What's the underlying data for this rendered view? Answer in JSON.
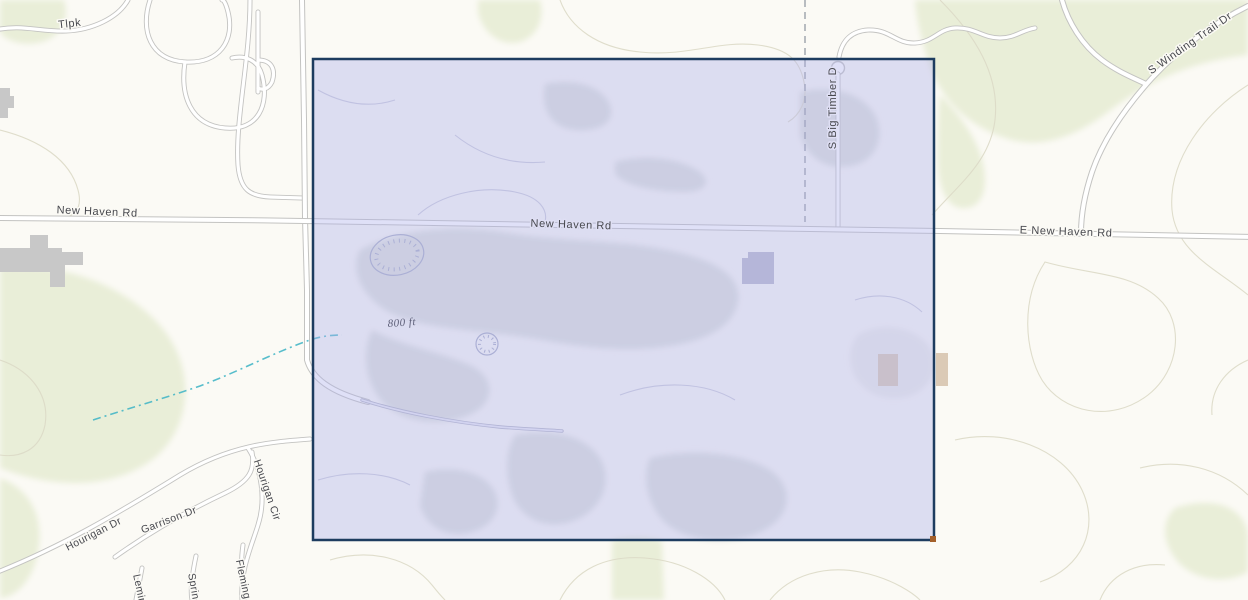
{
  "map": {
    "description": "Topographic street basemap with a rectangular parcel selection overlay",
    "labels": {
      "tlpk": "Tlpk",
      "new_haven_rd_left": "New Haven Rd",
      "new_haven_rd_center": "New Haven Rd",
      "e_new_haven_rd": "E New Haven Rd",
      "s_big_timber_dr": "S Big Timber D",
      "s_winding_trail_dr": "S Winding Trail Dr",
      "contour_800ft": "800 ft",
      "hourigan_dr": "Hourigan Dr",
      "garrison_dr": "Garrison Dr",
      "hourigan_cir": "Hourigan Cir",
      "leming": "Leming",
      "spring": "Spring",
      "fleming": "Fleming"
    },
    "selection": {
      "x": 313,
      "y": 59,
      "width": 621,
      "height": 481
    },
    "colors": {
      "background": "#fbfaf5",
      "vegetation": "#e9eed8",
      "contour": "#dcd9c6",
      "road_casing": "#c3c3c1",
      "road_fill": "#ffffff",
      "minor_road_casing": "#b4b6c6",
      "minor_road_inner": "#e9e9f4",
      "blob_gray": "#dfe2dd",
      "building_gray": "#c8c8c8",
      "building_lavender": "#b9bace",
      "building_tan": "#dbcab6",
      "stream": "#45b6c6",
      "boundary_dash": "#9ba1a9",
      "selection_fill": "rgba(174,177,235,0.40)",
      "selection_border": "#1d3c5f",
      "selection_handle": "#a35f2a",
      "label_text": "#47484e",
      "contour_label": "#5d5f78"
    }
  }
}
